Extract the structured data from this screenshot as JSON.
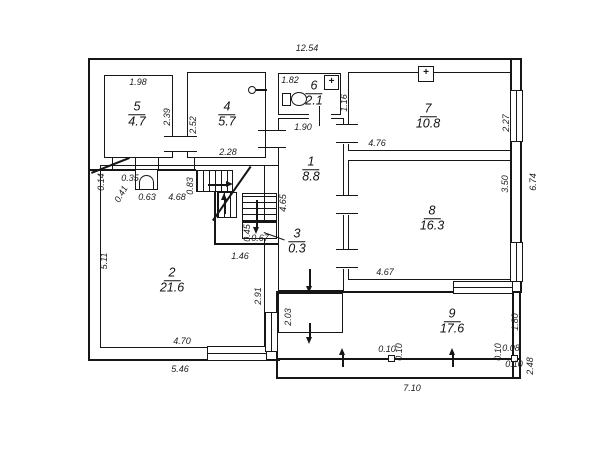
{
  "plan": {
    "type": "floor-plan",
    "symbols": {
      "flue_plus": "+"
    },
    "rooms": [
      {
        "number": "1",
        "area": "8.8",
        "x": 311,
        "y": 168
      },
      {
        "number": "2",
        "area": "21.6",
        "x": 172,
        "y": 279
      },
      {
        "number": "3",
        "area": "0.3",
        "x": 297,
        "y": 240
      },
      {
        "number": "4",
        "area": "5.7",
        "x": 227,
        "y": 113
      },
      {
        "number": "5",
        "area": "4.7",
        "x": 137,
        "y": 113
      },
      {
        "number": "6",
        "area": "2.1",
        "x": 314,
        "y": 92
      },
      {
        "number": "7",
        "area": "10.8",
        "x": 428,
        "y": 115
      },
      {
        "number": "8",
        "area": "16.3",
        "x": 432,
        "y": 217
      },
      {
        "number": "9",
        "area": "17.6",
        "x": 452,
        "y": 320
      }
    ],
    "dimensions": [
      {
        "text": "12.54",
        "x": 307,
        "y": 48,
        "rot": 0
      },
      {
        "text": "1.98",
        "x": 138,
        "y": 82,
        "rot": 0
      },
      {
        "text": "2.39",
        "x": 167,
        "y": 117,
        "rot": -90
      },
      {
        "text": "2.52",
        "x": 193,
        "y": 125,
        "rot": -90
      },
      {
        "text": "2.28",
        "x": 228,
        "y": 152,
        "rot": 0
      },
      {
        "text": "1.82",
        "x": 290,
        "y": 80,
        "rot": 0
      },
      {
        "text": "1.16",
        "x": 344,
        "y": 103,
        "rot": -90
      },
      {
        "text": "1.90",
        "x": 303,
        "y": 127,
        "rot": 0
      },
      {
        "text": "4.76",
        "x": 377,
        "y": 143,
        "rot": 0
      },
      {
        "text": "2.27",
        "x": 506,
        "y": 123,
        "rot": -90
      },
      {
        "text": "6.74",
        "x": 533,
        "y": 182,
        "rot": -90
      },
      {
        "text": "3.50",
        "x": 505,
        "y": 184,
        "rot": -90
      },
      {
        "text": "4.65",
        "x": 283,
        "y": 203,
        "rot": -90
      },
      {
        "text": "4.67",
        "x": 385,
        "y": 272,
        "rot": 0
      },
      {
        "text": "0.14",
        "x": 101,
        "y": 182,
        "rot": -90
      },
      {
        "text": "0.35",
        "x": 130,
        "y": 178,
        "rot": 0
      },
      {
        "text": "0.41",
        "x": 121,
        "y": 194,
        "rot": -60
      },
      {
        "text": "0.63",
        "x": 147,
        "y": 197,
        "rot": 0
      },
      {
        "text": "4.68",
        "x": 177,
        "y": 197,
        "rot": 0
      },
      {
        "text": "0.83",
        "x": 190,
        "y": 186,
        "rot": -90
      },
      {
        "text": "5.11",
        "x": 104,
        "y": 261,
        "rot": -90
      },
      {
        "text": "0.45",
        "x": 247,
        "y": 233,
        "rot": -90
      },
      {
        "text": "0.67",
        "x": 260,
        "y": 238,
        "rot": 0
      },
      {
        "text": "1.46",
        "x": 240,
        "y": 256,
        "rot": 0
      },
      {
        "text": "2.91",
        "x": 258,
        "y": 296,
        "rot": -90
      },
      {
        "text": "2.03",
        "x": 288,
        "y": 317,
        "rot": -90
      },
      {
        "text": "4.70",
        "x": 182,
        "y": 341,
        "rot": 0
      },
      {
        "text": "5.46",
        "x": 180,
        "y": 369,
        "rot": 0
      },
      {
        "text": "1.80",
        "x": 515,
        "y": 322,
        "rot": -90
      },
      {
        "text": "0.10",
        "x": 387,
        "y": 349,
        "rot": 0
      },
      {
        "text": "0.10",
        "x": 399,
        "y": 352,
        "rot": -90
      },
      {
        "text": "0.10",
        "x": 498,
        "y": 352,
        "rot": -90
      },
      {
        "text": "0.08",
        "x": 511,
        "y": 348,
        "rot": 0
      },
      {
        "text": "0.10",
        "x": 514,
        "y": 364,
        "rot": 0
      },
      {
        "text": "2.48",
        "x": 530,
        "y": 366,
        "rot": -90
      },
      {
        "text": "7.10",
        "x": 412,
        "y": 388,
        "rot": 0
      }
    ]
  }
}
